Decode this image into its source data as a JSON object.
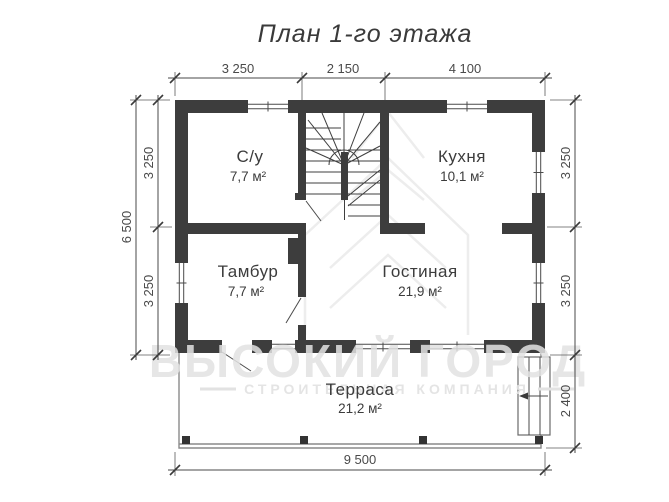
{
  "title": "План 1-го этажа",
  "rooms": {
    "su": {
      "name": "С/у",
      "area": "7,7 м²"
    },
    "kitchen": {
      "name": "Кухня",
      "area": "10,1 м²"
    },
    "tambur": {
      "name": "Тамбур",
      "area": "7,7 м²"
    },
    "living": {
      "name": "Гостиная",
      "area": "21,9 м²"
    },
    "terrace": {
      "name": "Терраса",
      "area": "21,2 м²"
    }
  },
  "dimensions": {
    "top": [
      "3 250",
      "2 150",
      "4 100"
    ],
    "left_total": "6 500",
    "left_segments": [
      "3 250",
      "3 250"
    ],
    "right": [
      "3 250",
      "3 250",
      "2 400"
    ],
    "bottom": "9 500"
  },
  "watermark": {
    "line1": "ВЫСОКИЙ ГОРОД",
    "line2": "СТРОИТЕЛЬНАЯ КОМПАНИЯ"
  },
  "colors": {
    "wall": "#3d3d3d",
    "lines": "#4a4a4a",
    "watermark": "#e2e2e2",
    "background": "#ffffff"
  }
}
